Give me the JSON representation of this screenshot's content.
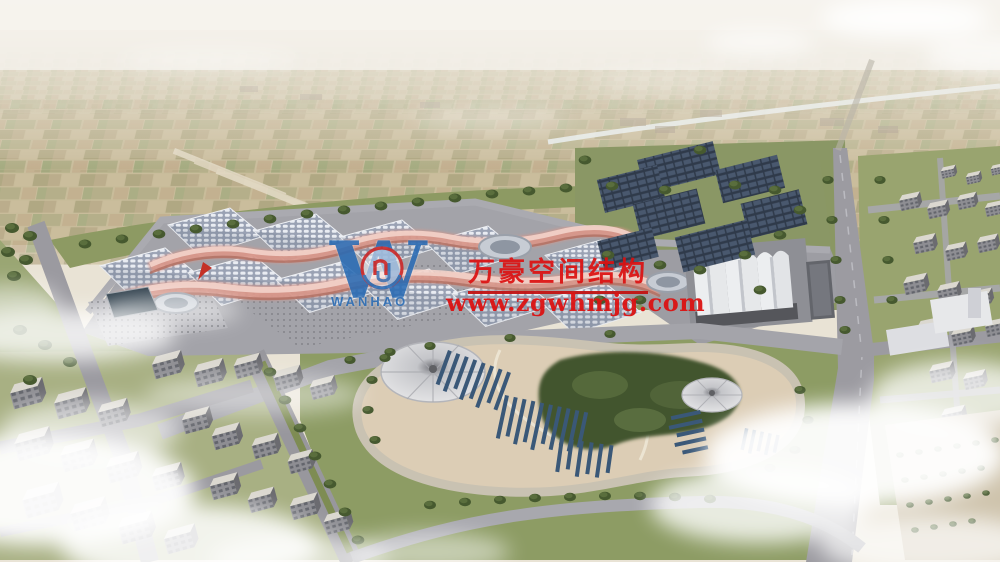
{
  "watermark": {
    "logo_letter": "W",
    "logo_wordmark": "WANHAO",
    "company_name": "万豪空间结构",
    "website_url": "www.zgwhmjg.com",
    "logo_color": "#2a6cb4",
    "red_color": "#dc1212"
  }
}
